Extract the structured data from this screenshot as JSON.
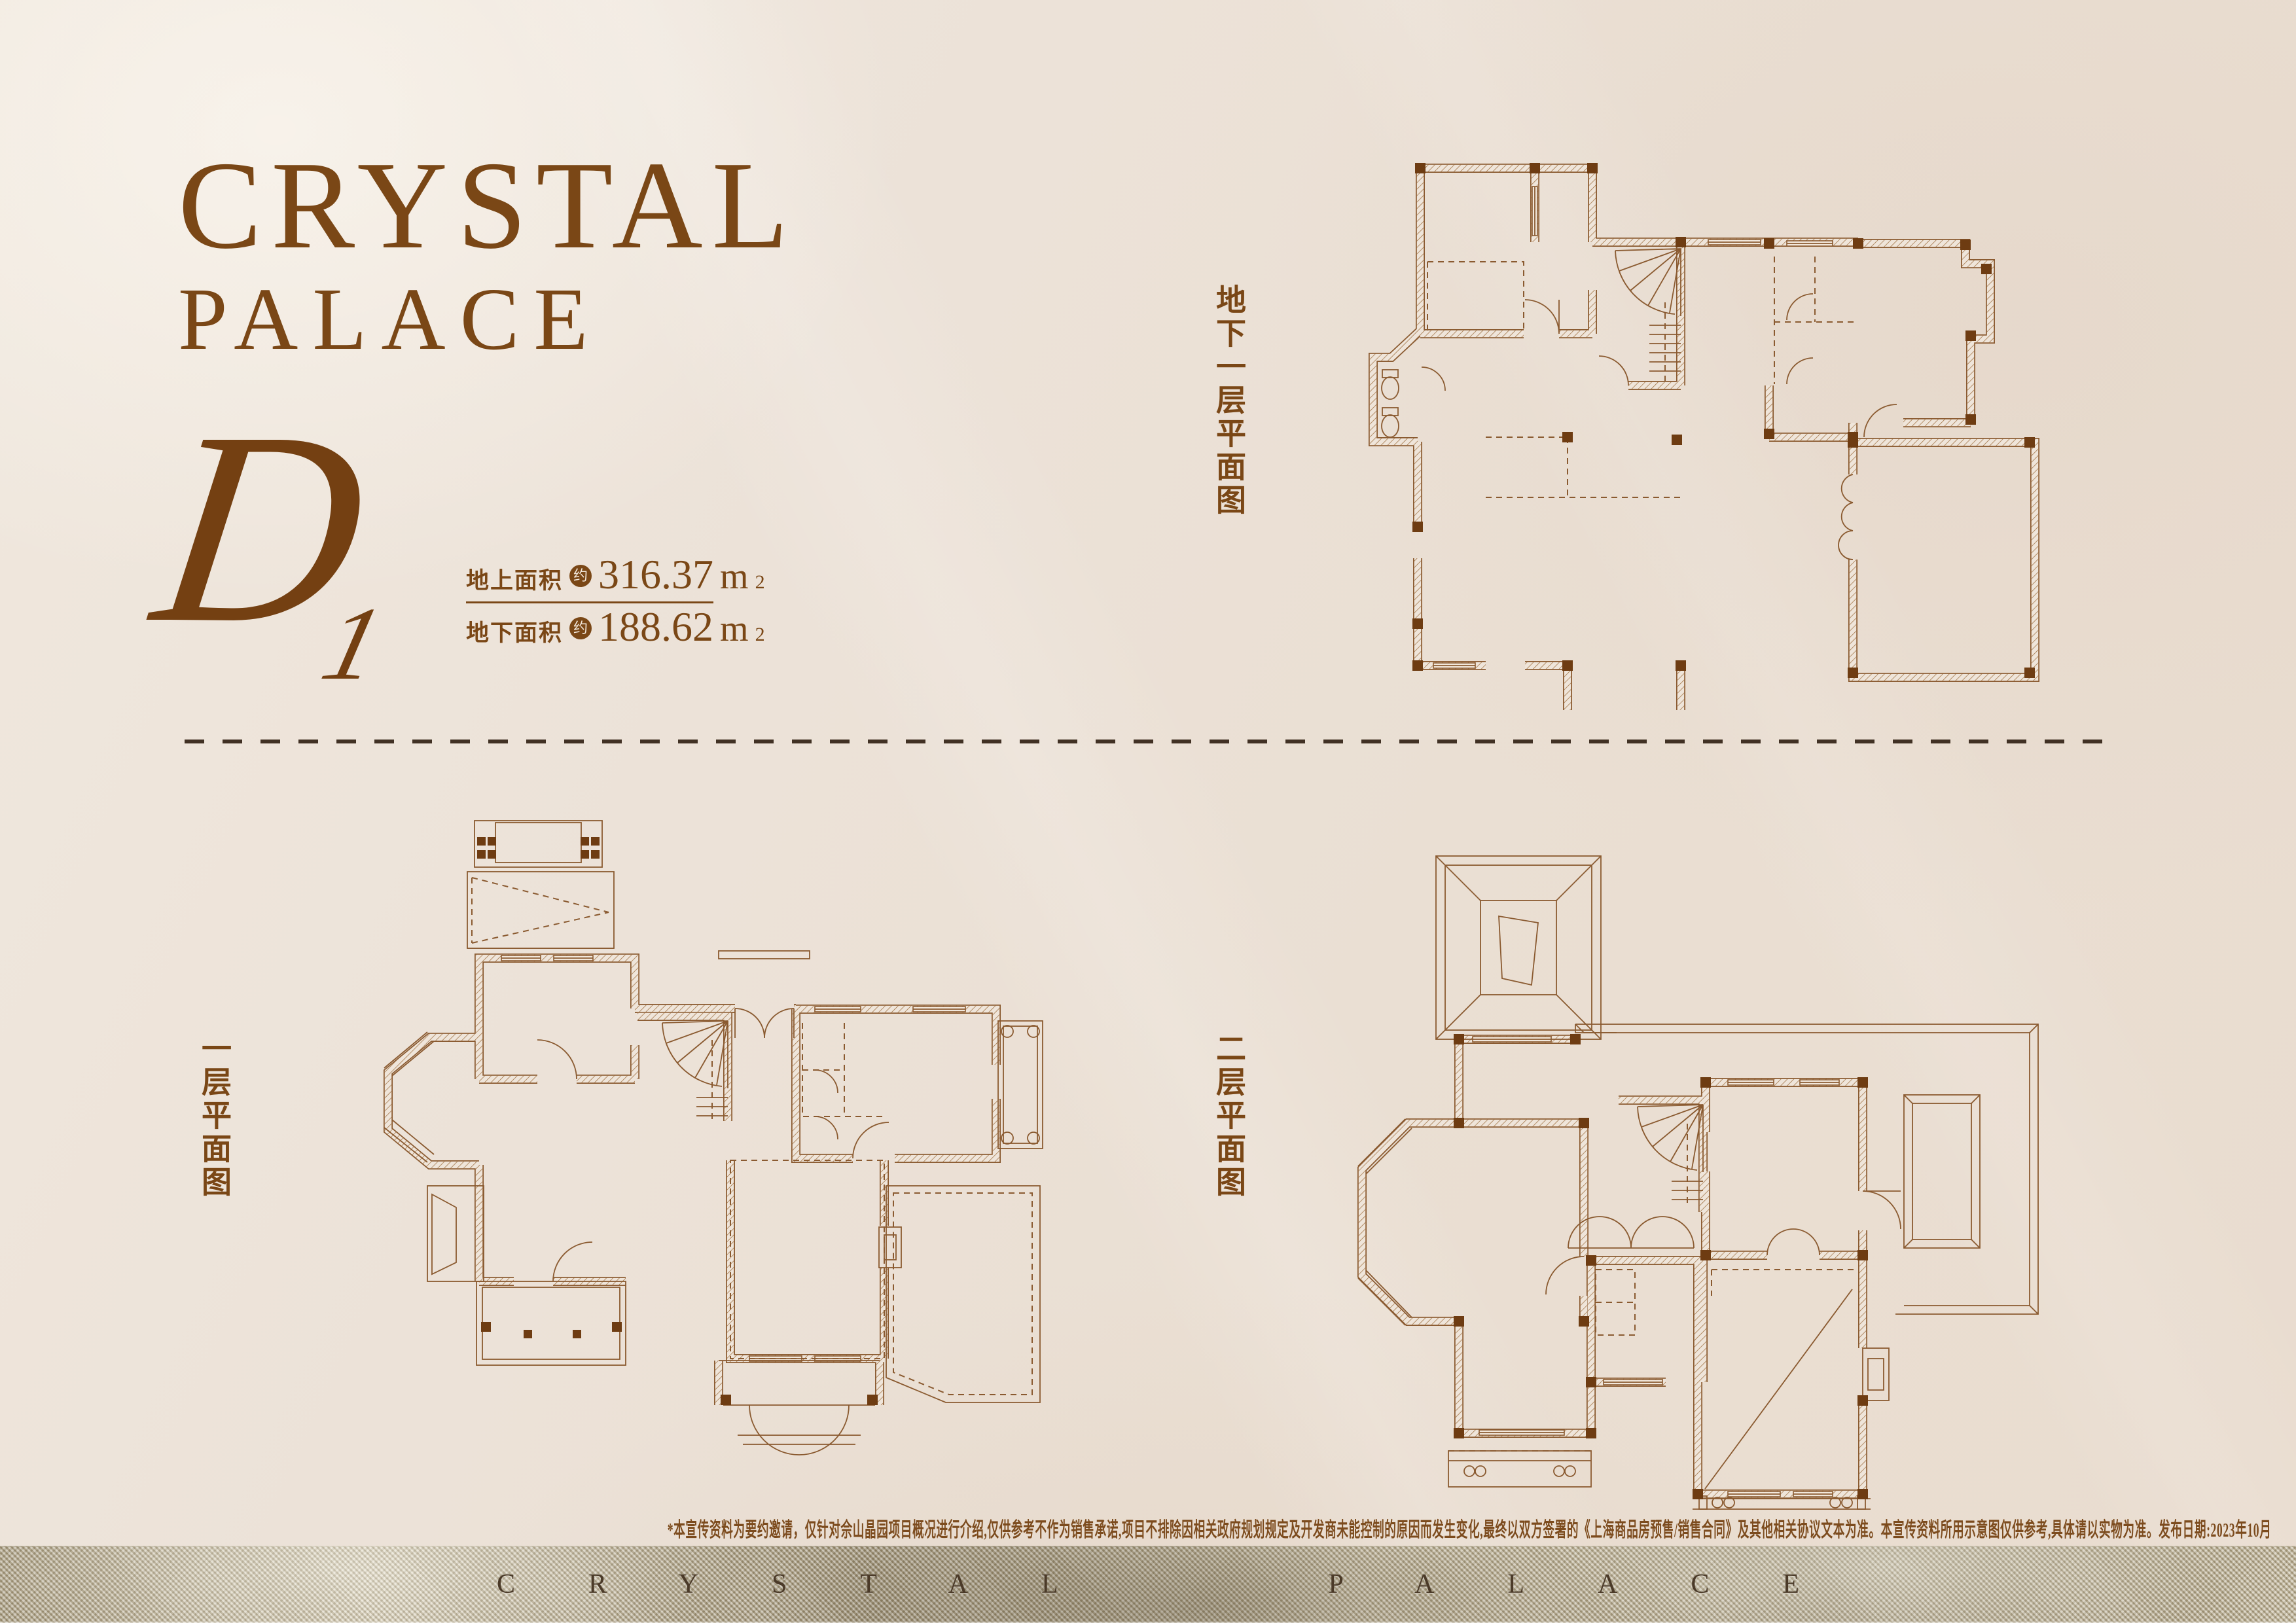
{
  "colors": {
    "background": "#ece2d8",
    "accent_brown": "#7a4716",
    "plan_line": "#8a5a30",
    "column_fill": "#6e3c12",
    "divider_dash": "#413124",
    "footer_metal_light": "#d6ccb1",
    "footer_metal_dark": "#a2967b",
    "footer_text": "#4b3a28"
  },
  "header": {
    "title_line1": "CRYSTAL",
    "title_line2": "PALACE"
  },
  "unit": {
    "letter": "D",
    "number": "1"
  },
  "areas": [
    {
      "label": "地上面积",
      "approx_badge": "约",
      "value": "316.37",
      "unit": "m",
      "power": "2"
    },
    {
      "label": "地下面积",
      "approx_badge": "约",
      "value": "188.62",
      "unit": "m",
      "power": "2"
    }
  ],
  "plans": [
    {
      "id": "basement-level",
      "label": "地下一层平面图"
    },
    {
      "id": "first-floor",
      "label": "一层平面图"
    },
    {
      "id": "second-floor",
      "label": "二层平面图"
    }
  ],
  "disclaimer": "*本宣传资料为要约邀请，仅针对佘山晶园项目概况进行介绍,仅供参考不作为销售承诺,项目不排除因相关政府规划规定及开发商未能控制的原因而发生变化,最终以双方签署的《上海商品房预售/销售合同》及其他相关协议文本为准。本宣传资料所用示意图仅供参考,具体请以实物为准。发布日期:2023年10月",
  "footer": {
    "brand": "CRYSTAL PALACE"
  }
}
